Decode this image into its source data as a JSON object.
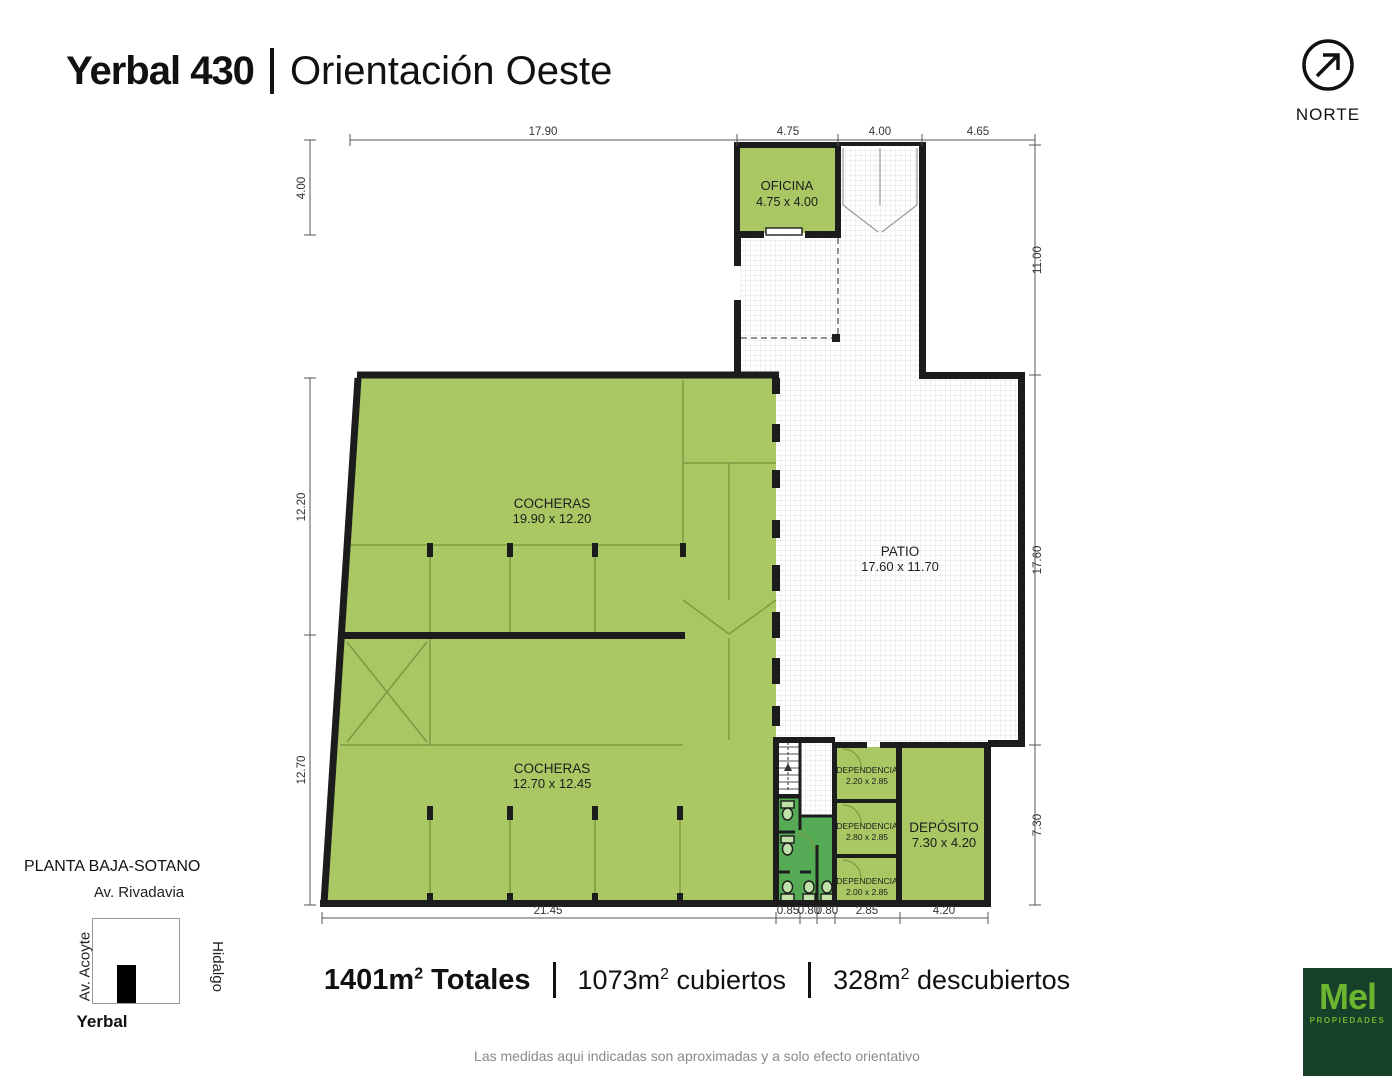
{
  "header": {
    "title": "Yerbal 430",
    "subtitle": "Orientación Oeste"
  },
  "north": {
    "label": "NORTE"
  },
  "colors": {
    "room_fill": "#a9c863",
    "sanitary_fill": "#55ab55",
    "wall": "#1c1c1c",
    "hatch_line": "#d9d9d9",
    "logo_bg": "#17402b",
    "logo_green": "#6cb52e"
  },
  "plan": {
    "rooms": {
      "oficina": {
        "name": "OFICINA",
        "size": "4.75 x 4.00"
      },
      "cocheras_top": {
        "name": "COCHERAS",
        "size": "19.90 x 12.20"
      },
      "patio": {
        "name": "PATIO",
        "size": "17.60 x 11.70"
      },
      "cocheras_bottom": {
        "name": "COCHERAS",
        "size": "12.70 x 12.45"
      },
      "dependencia_1": {
        "name": "DEPENDENCIA",
        "size": "2.20 x 2.85"
      },
      "dependencia_2": {
        "name": "DEPENDENCIA",
        "size": "2.80 x 2.85"
      },
      "dependencia_3": {
        "name": "DEPENDENCIA",
        "size": "2.00 x 2.85"
      },
      "deposito": {
        "name": "DEPÓSITO",
        "size": "7.30 x 4.20"
      }
    },
    "dimensions": {
      "top": [
        "17.90",
        "4.75",
        "4.00",
        "4.65"
      ],
      "left": [
        "4.00",
        "12.20",
        "12.70"
      ],
      "right": [
        "11.00",
        "17.60",
        "7.30"
      ],
      "bottom": [
        "21.45",
        "0.85",
        "0.80",
        "0.80",
        "2.85",
        "4.20"
      ]
    }
  },
  "legend": {
    "title": "PLANTA BAJA-SOTANO",
    "street_top": "Av. Rivadavia",
    "street_left": "Av. Acoyte",
    "street_right": "Hidalgo",
    "street_bottom": "Yerbal"
  },
  "totals": {
    "segments": [
      {
        "value": "1401m",
        "sup": "2",
        "label": " Totales"
      },
      {
        "value": "1073m",
        "sup": "2",
        "label": " cubiertos"
      },
      {
        "value": "328m",
        "sup": "2",
        "label": " descubiertos"
      }
    ]
  },
  "footer": {
    "disclaimer": "Las medidas aqui indicadas son aproximadas y a solo efecto orientativo"
  },
  "logo": {
    "name": "Mel",
    "tagline": "PROPIEDADES"
  }
}
